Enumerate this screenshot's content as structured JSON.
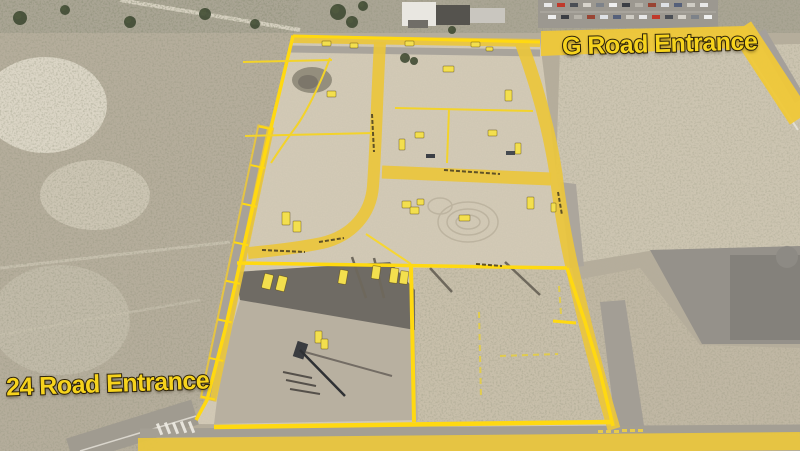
{
  "labels": {
    "entrance_top": "G Road Entrance",
    "entrance_bottom": "24 Road Entrance"
  },
  "colors": {
    "annotation_yellow": "#eac63c",
    "boundary_yellow": "#ffd911",
    "marker_yellow": "#f3df4e",
    "label_text": "#f6d31d",
    "label_outline": "#30260e",
    "dirt_inside": "#d3cab6",
    "scrub_outside": "#b5ad9b",
    "asphalt": "#6f6b64"
  },
  "overlay": {
    "lot_markers": [
      {
        "x": 322,
        "y": 41,
        "w": 9,
        "h": 5,
        "rot": 0
      },
      {
        "x": 350,
        "y": 43,
        "w": 8,
        "h": 5,
        "rot": 0
      },
      {
        "x": 405,
        "y": 41,
        "w": 9,
        "h": 5,
        "rot": 0
      },
      {
        "x": 471,
        "y": 42,
        "w": 9,
        "h": 5,
        "rot": 0
      },
      {
        "x": 486,
        "y": 47,
        "w": 7,
        "h": 4,
        "rot": 0
      },
      {
        "x": 443,
        "y": 66,
        "w": 11,
        "h": 6,
        "rot": 0
      },
      {
        "x": 327,
        "y": 91,
        "w": 9,
        "h": 6,
        "rot": 0
      },
      {
        "x": 505,
        "y": 90,
        "w": 7,
        "h": 11,
        "rot": 0
      },
      {
        "x": 415,
        "y": 132,
        "w": 9,
        "h": 6,
        "rot": 0
      },
      {
        "x": 488,
        "y": 130,
        "w": 9,
        "h": 6,
        "rot": 0
      },
      {
        "x": 399,
        "y": 139,
        "w": 6,
        "h": 11,
        "rot": 0
      },
      {
        "x": 515,
        "y": 143,
        "w": 6,
        "h": 11,
        "rot": 0
      },
      {
        "x": 551,
        "y": 203,
        "w": 5,
        "h": 9,
        "rot": 0
      },
      {
        "x": 402,
        "y": 201,
        "w": 9,
        "h": 7,
        "rot": 0
      },
      {
        "x": 410,
        "y": 207,
        "w": 9,
        "h": 7,
        "rot": 0
      },
      {
        "x": 417,
        "y": 199,
        "w": 7,
        "h": 6,
        "rot": 0
      },
      {
        "x": 527,
        "y": 197,
        "w": 7,
        "h": 12,
        "rot": 0
      },
      {
        "x": 459,
        "y": 215,
        "w": 11,
        "h": 6,
        "rot": 0
      },
      {
        "x": 282,
        "y": 212,
        "w": 8,
        "h": 13,
        "rot": 0
      },
      {
        "x": 293,
        "y": 221,
        "w": 8,
        "h": 11,
        "rot": 0
      },
      {
        "x": 263,
        "y": 274,
        "w": 9,
        "h": 15,
        "rot": 14
      },
      {
        "x": 277,
        "y": 276,
        "w": 9,
        "h": 15,
        "rot": 14
      },
      {
        "x": 339,
        "y": 270,
        "w": 8,
        "h": 14,
        "rot": 10
      },
      {
        "x": 372,
        "y": 266,
        "w": 8,
        "h": 13,
        "rot": 8
      },
      {
        "x": 390,
        "y": 268,
        "w": 8,
        "h": 15,
        "rot": 8
      },
      {
        "x": 400,
        "y": 271,
        "w": 8,
        "h": 13,
        "rot": 8
      },
      {
        "x": 315,
        "y": 331,
        "w": 7,
        "h": 12,
        "rot": 0
      },
      {
        "x": 321,
        "y": 339,
        "w": 7,
        "h": 10,
        "rot": 0
      }
    ]
  },
  "photo": {
    "car_colors": [
      "#e8e8e8",
      "#c0392b",
      "#4a4e55",
      "#d8d4cc",
      "#7d8289",
      "#efefef",
      "#3b3e44",
      "#b7b3aa",
      "#994433",
      "#dfe2e6",
      "#55607a",
      "#cfccc4"
    ],
    "trees": [
      {
        "x": 338,
        "y": 12,
        "r": 8
      },
      {
        "x": 352,
        "y": 22,
        "r": 6
      },
      {
        "x": 363,
        "y": 6,
        "r": 5
      },
      {
        "x": 405,
        "y": 58,
        "r": 5
      },
      {
        "x": 414,
        "y": 61,
        "r": 4
      },
      {
        "x": 452,
        "y": 30,
        "r": 4
      },
      {
        "x": 20,
        "y": 18,
        "r": 7
      },
      {
        "x": 65,
        "y": 10,
        "r": 5
      },
      {
        "x": 130,
        "y": 22,
        "r": 6
      },
      {
        "x": 205,
        "y": 14,
        "r": 6
      },
      {
        "x": 255,
        "y": 24,
        "r": 5
      }
    ]
  }
}
